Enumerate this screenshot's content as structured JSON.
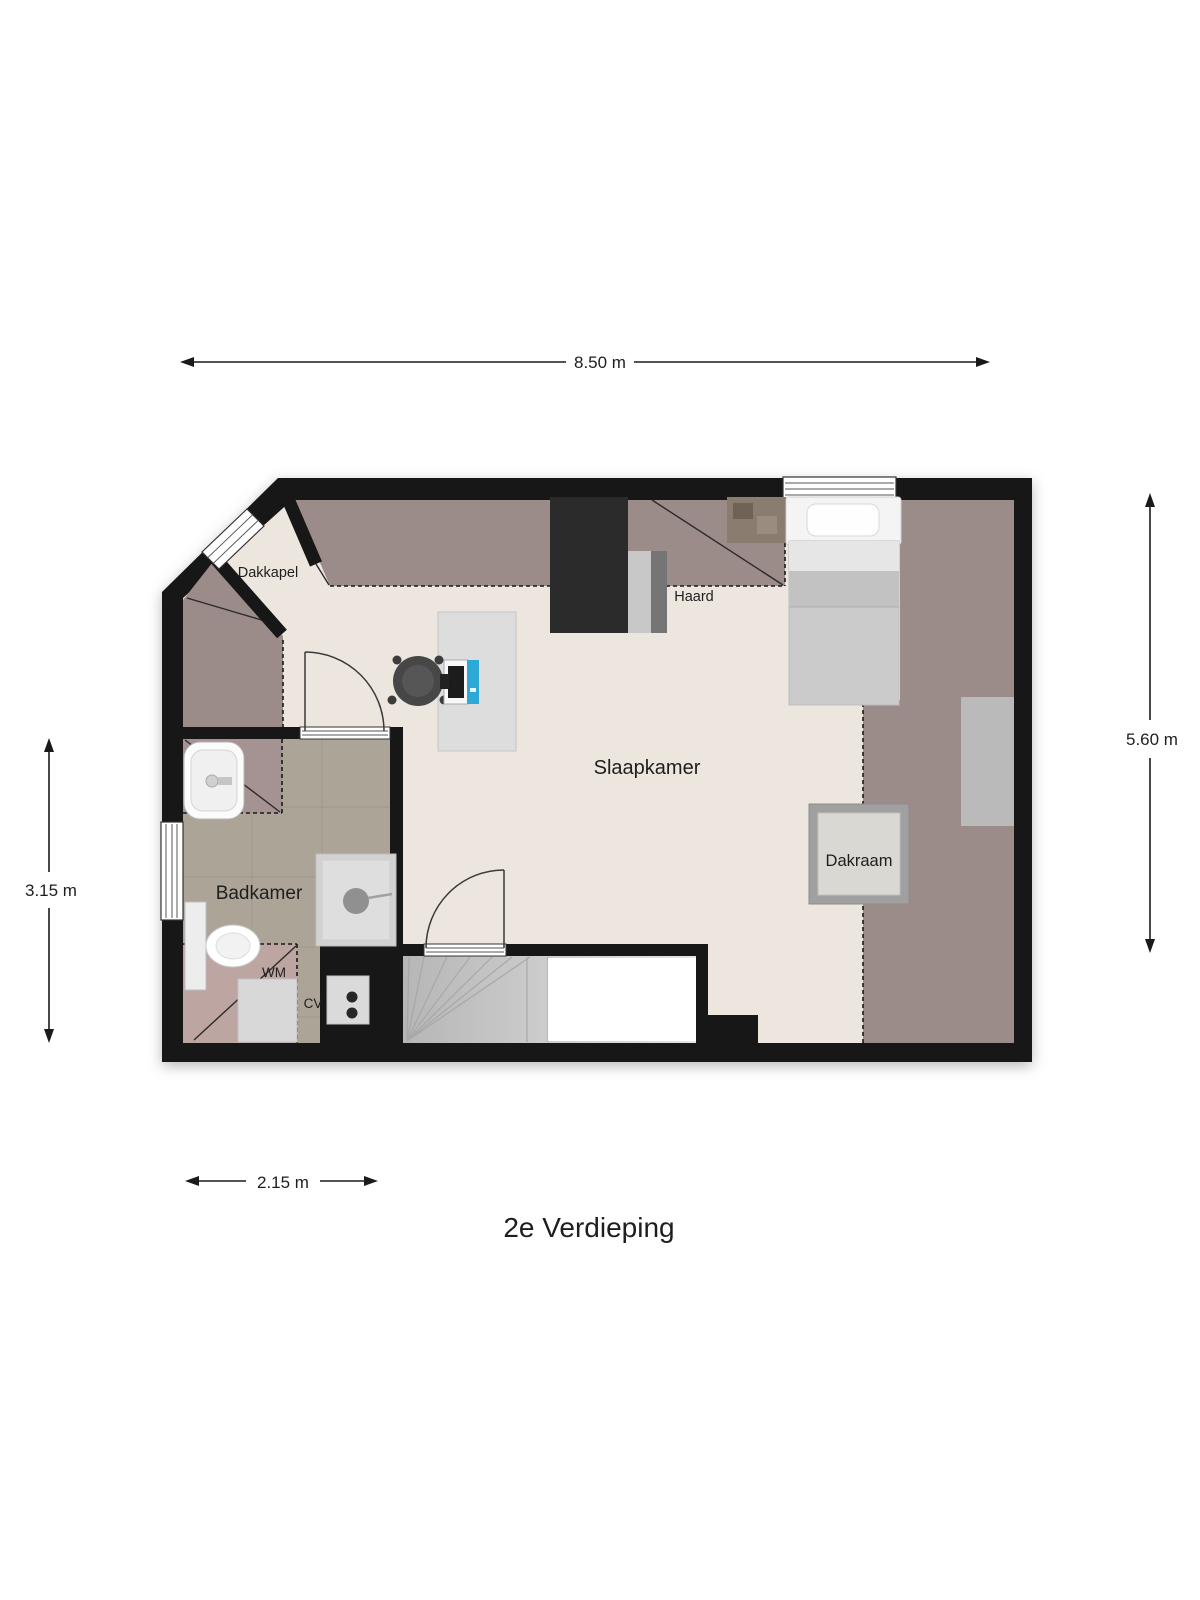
{
  "title": "2e Verdieping",
  "dimensions": {
    "top": "8.50 m",
    "right": "5.60 m",
    "left": "3.15 m",
    "bottom": "2.15 m"
  },
  "rooms": {
    "bedroom": {
      "label": "Slaapkamer"
    },
    "bathroom": {
      "label": "Badkamer"
    }
  },
  "features": {
    "dormer": {
      "label": "Dakkapel"
    },
    "fireplace": {
      "label": "Haard"
    },
    "roof_window": {
      "label": "Dakraam"
    },
    "washing_machine": {
      "label": "WM"
    },
    "central_heating": {
      "label": "CV"
    }
  },
  "colors": {
    "wall": "#171717",
    "floor": "#EDE6DF",
    "sloped_ceiling": "#9B8C8A",
    "bathroom_sloped": "#A59292",
    "bathroom_sloped_light": "#BDA5A2",
    "bathroom_tile": "#ACA497",
    "monitor_accent": "#2EA9D6"
  }
}
